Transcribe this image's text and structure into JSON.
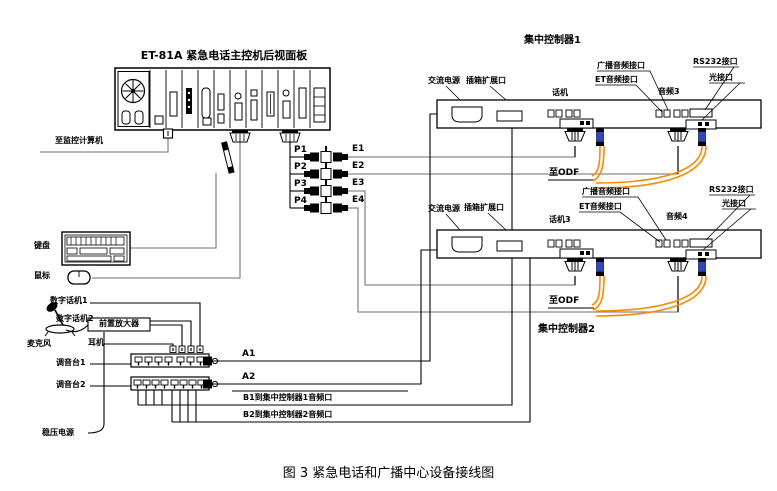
{
  "caption": "图 3  紧急电话和广播中心设备接线图",
  "main_panel": {
    "title": "ET-81A 紧急电话主控机后视面板"
  },
  "left_area": {
    "to_monitor": "至监控计算机",
    "keyboard": "键盘",
    "mouse": "鼠标",
    "digital_phone_1": "数字话机1",
    "digital_phone_2": "数字话机2",
    "preamp": "前置放大器",
    "microphone": "麦克风",
    "headset": "耳机",
    "mixer_1": "调音台1",
    "mixer_2": "调音台2",
    "power_supply": "稳压电源"
  },
  "bus": {
    "a1": "A1",
    "a2": "A2",
    "b1": "B1到集中控制器1音频口",
    "b2": "B2到集中控制器2音频口",
    "p_ports": [
      "P1",
      "P2",
      "P3",
      "P4"
    ],
    "e_ports": [
      "E1",
      "E2",
      "E3",
      "E4"
    ]
  },
  "controller_1": {
    "title": "集中控制器1",
    "ac_power": "交流电源",
    "expansion_port": "插箱扩展口",
    "phone_port": "话机",
    "broadcast_audio_port": "广播音频接口",
    "et_audio_port": "ET音频接口",
    "audio_port": "音频3",
    "rs232_port": "RS232接口",
    "optical_port": "光接口",
    "to_odf": "至ODF"
  },
  "controller_2": {
    "title": "集中控制器2",
    "ac_power": "交流电源",
    "expansion_port": "插箱扩展口",
    "phone_port": "话机3",
    "broadcast_audio_port": "广播音频接口",
    "et_audio_port": "ET音频接口",
    "audio_port": "音频4",
    "rs232_port": "RS232接口",
    "optical_port": "光接口",
    "to_odf": "至ODF"
  },
  "colors": {
    "line": "#000000",
    "cable_gray": "#8a8a8a",
    "fiber_orange": "#ff8a00",
    "fiber_connector_blue": "#2b46cc"
  }
}
